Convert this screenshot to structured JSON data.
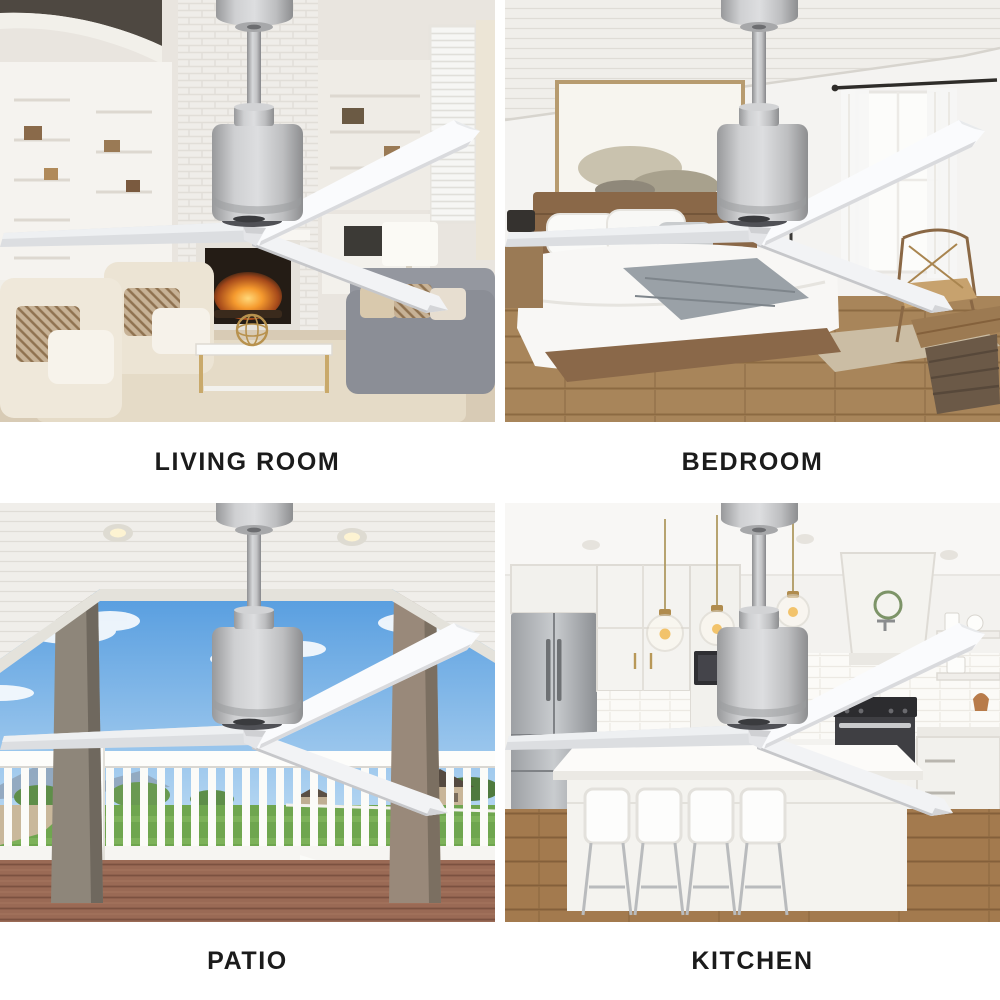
{
  "quadrants": [
    {
      "id": "living-room",
      "label": "LIVING ROOM"
    },
    {
      "id": "bedroom",
      "label": "BEDROOM"
    },
    {
      "id": "patio",
      "label": "PATIO"
    },
    {
      "id": "kitchen",
      "label": "KITCHEN"
    }
  ],
  "colors": {
    "background": "#ffffff",
    "label_text": "#1b1b1b",
    "fan_motor_silver": "#c3c4c6",
    "fan_blade_white": "#f5f6f8"
  }
}
